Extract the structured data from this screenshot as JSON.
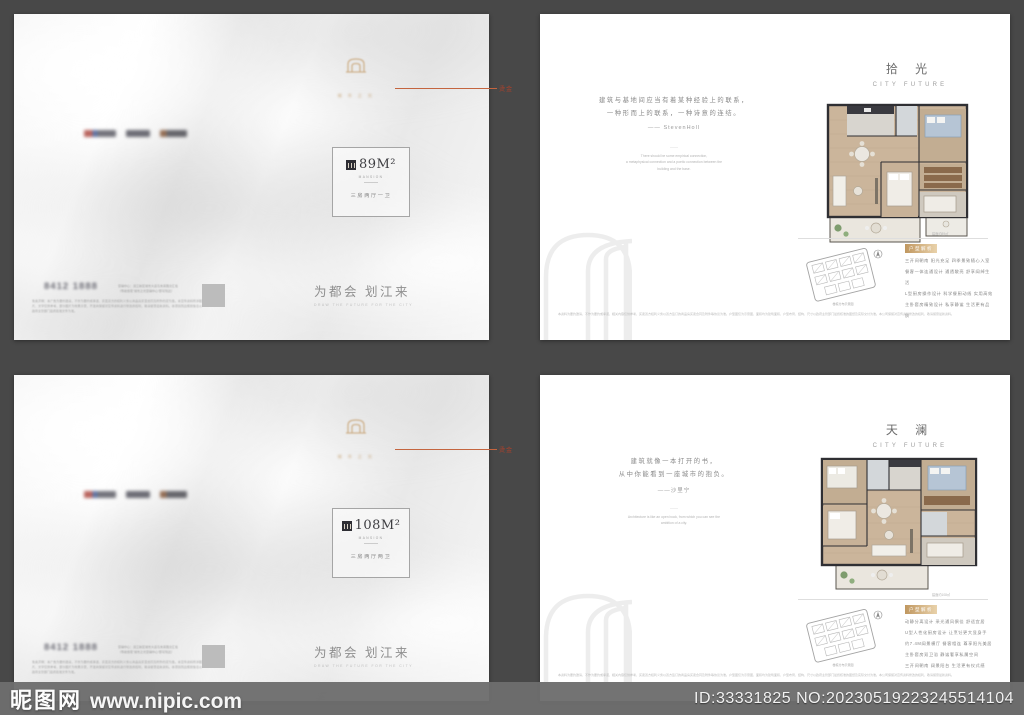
{
  "print_note": {
    "label": "烫金"
  },
  "watermark_bar": {
    "site_name": "昵图网",
    "site_url": "www.nipic.com",
    "id_text": "ID:33331825 NO:20230519223245514104"
  },
  "covers": [
    {
      "emblem_text": "城 市 之 光",
      "badge": {
        "area": "89M²",
        "brand": "MANSION",
        "unit_type": "三房两厅一卫"
      },
      "tagline_cn": "为都会 划江来",
      "tagline_en": "DRAW THE FUTURE FOR THE CITY",
      "contact": {
        "phone": "8412 1888",
        "addr1": "营销中心：滨江新区城市大道与未来路交汇处",
        "addr2": "（导航搜索“城市之光营销中心”即可到达）",
        "legal": "免责声明：本广告为要约邀请，不作为要约或承诺，买卖双方的权利义务以商品房买卖合同及附件约定为准。本宣传资料所涉图片、文字仅供参考，部分图片为效果示意，开发商保留对宣传资料进行修改的权利，敬请留意最新资料。本项目周边规划信息以政府主管部门最终批准文件为准。"
      }
    },
    {
      "emblem_text": "城 市 之 光",
      "badge": {
        "area": "108M²",
        "brand": "MANSION",
        "unit_type": "三房两厅两卫"
      },
      "tagline_cn": "为都会 划江来",
      "tagline_en": "DRAW THE FUTURE FOR THE CITY",
      "contact": {
        "phone": "8412 1888",
        "addr1": "营销中心：滨江新区城市大道与未来路交汇处",
        "addr2": "（导航搜索“城市之光营销中心”即可到达）",
        "legal": "免责声明：本广告为要约邀请，不作为要约或承诺，买卖双方的权利义务以商品房买卖合同及附件约定为准。本宣传资料所涉图片、文字仅供参考，部分图片为效果示意，开发商保留对宣传资料进行修改的权利，敬请留意最新资料。本项目周边规划信息以政府主管部门最终批准文件为准。"
      }
    }
  ],
  "pages": [
    {
      "title_cn": "拾 光",
      "title_en": "CITY FUTURE",
      "quote_cn1": "建筑与基地间应当有着某种经验上的联系，",
      "quote_cn2": "一种形而上的联系，一种诗意的连结。",
      "quote_attr": "—— StevenHoll",
      "quote_divider": "——",
      "quote_en1": "There should be some empirical connection,",
      "quote_en2": "a metaphysical connection and a poetic connection between the",
      "quote_en3": "building and the base.",
      "plan_caption": "建面约89㎡",
      "keyplan_caption": "楼栋分布示意图",
      "feature_label": "户型解析",
      "features": [
        "三开间朝南 阳光充足 四季景致随心入室",
        "餐客一体连通设计 通透敞亮 舒享阔绰生活",
        "L型厨房操作设计 科学餐厨动线 实用高效",
        "主卧套房精致设计 私享静谧 生活更有品质"
      ],
      "disclaimer": "本资料为要约邀请，不作为要约或承诺，相关内容仅供参考，买卖双方权利义务以双方签订的商品房买卖合同及附件等协议为准。户型图仅为示意图，面积均为建筑面积，户型布局、结构、尺寸以政府主管部门最终核准的图纸及实际交付为准。本公司保留对宣传资料修改的权利，敬请留意最新资料。"
    },
    {
      "title_cn": "天 澜",
      "title_en": "CITY FUTURE",
      "quote_cn1": "建筑就像一本打开的书，",
      "quote_cn2": "从中你能看到一座城市的抱负。",
      "quote_attr": "——沙里宁",
      "quote_divider": "——",
      "quote_en1": "Architecture is like an open book, from which you can see the",
      "quote_en2": "ambition of a city.",
      "quote_en3": "",
      "plan_caption": "建面约108㎡",
      "keyplan_caption": "楼栋分布示意图",
      "feature_label": "户型解析",
      "features": [
        "动静分离设计 采光通风俱佳 舒适宜居",
        "U型人性化厨房设计 让烹饪更大显身手",
        "约7.4M阔景横厅 餐客相连 尊享阳光美居",
        "主卧套房双卫浴 静谧奢享私属空间",
        "三开间朝南 阔景阳台 生活更有仪式感"
      ],
      "disclaimer": "本资料为要约邀请，不作为要约或承诺，相关内容仅供参考，买卖双方权利义务以双方签订的商品房买卖合同及附件等协议为准。户型图仅为示意图，面积均为建筑面积，户型布局、结构、尺寸以政府主管部门最终核准的图纸及实际交付为准。本公司保留对宣传资料修改的权利，敬请留意最新资料。"
    }
  ]
}
